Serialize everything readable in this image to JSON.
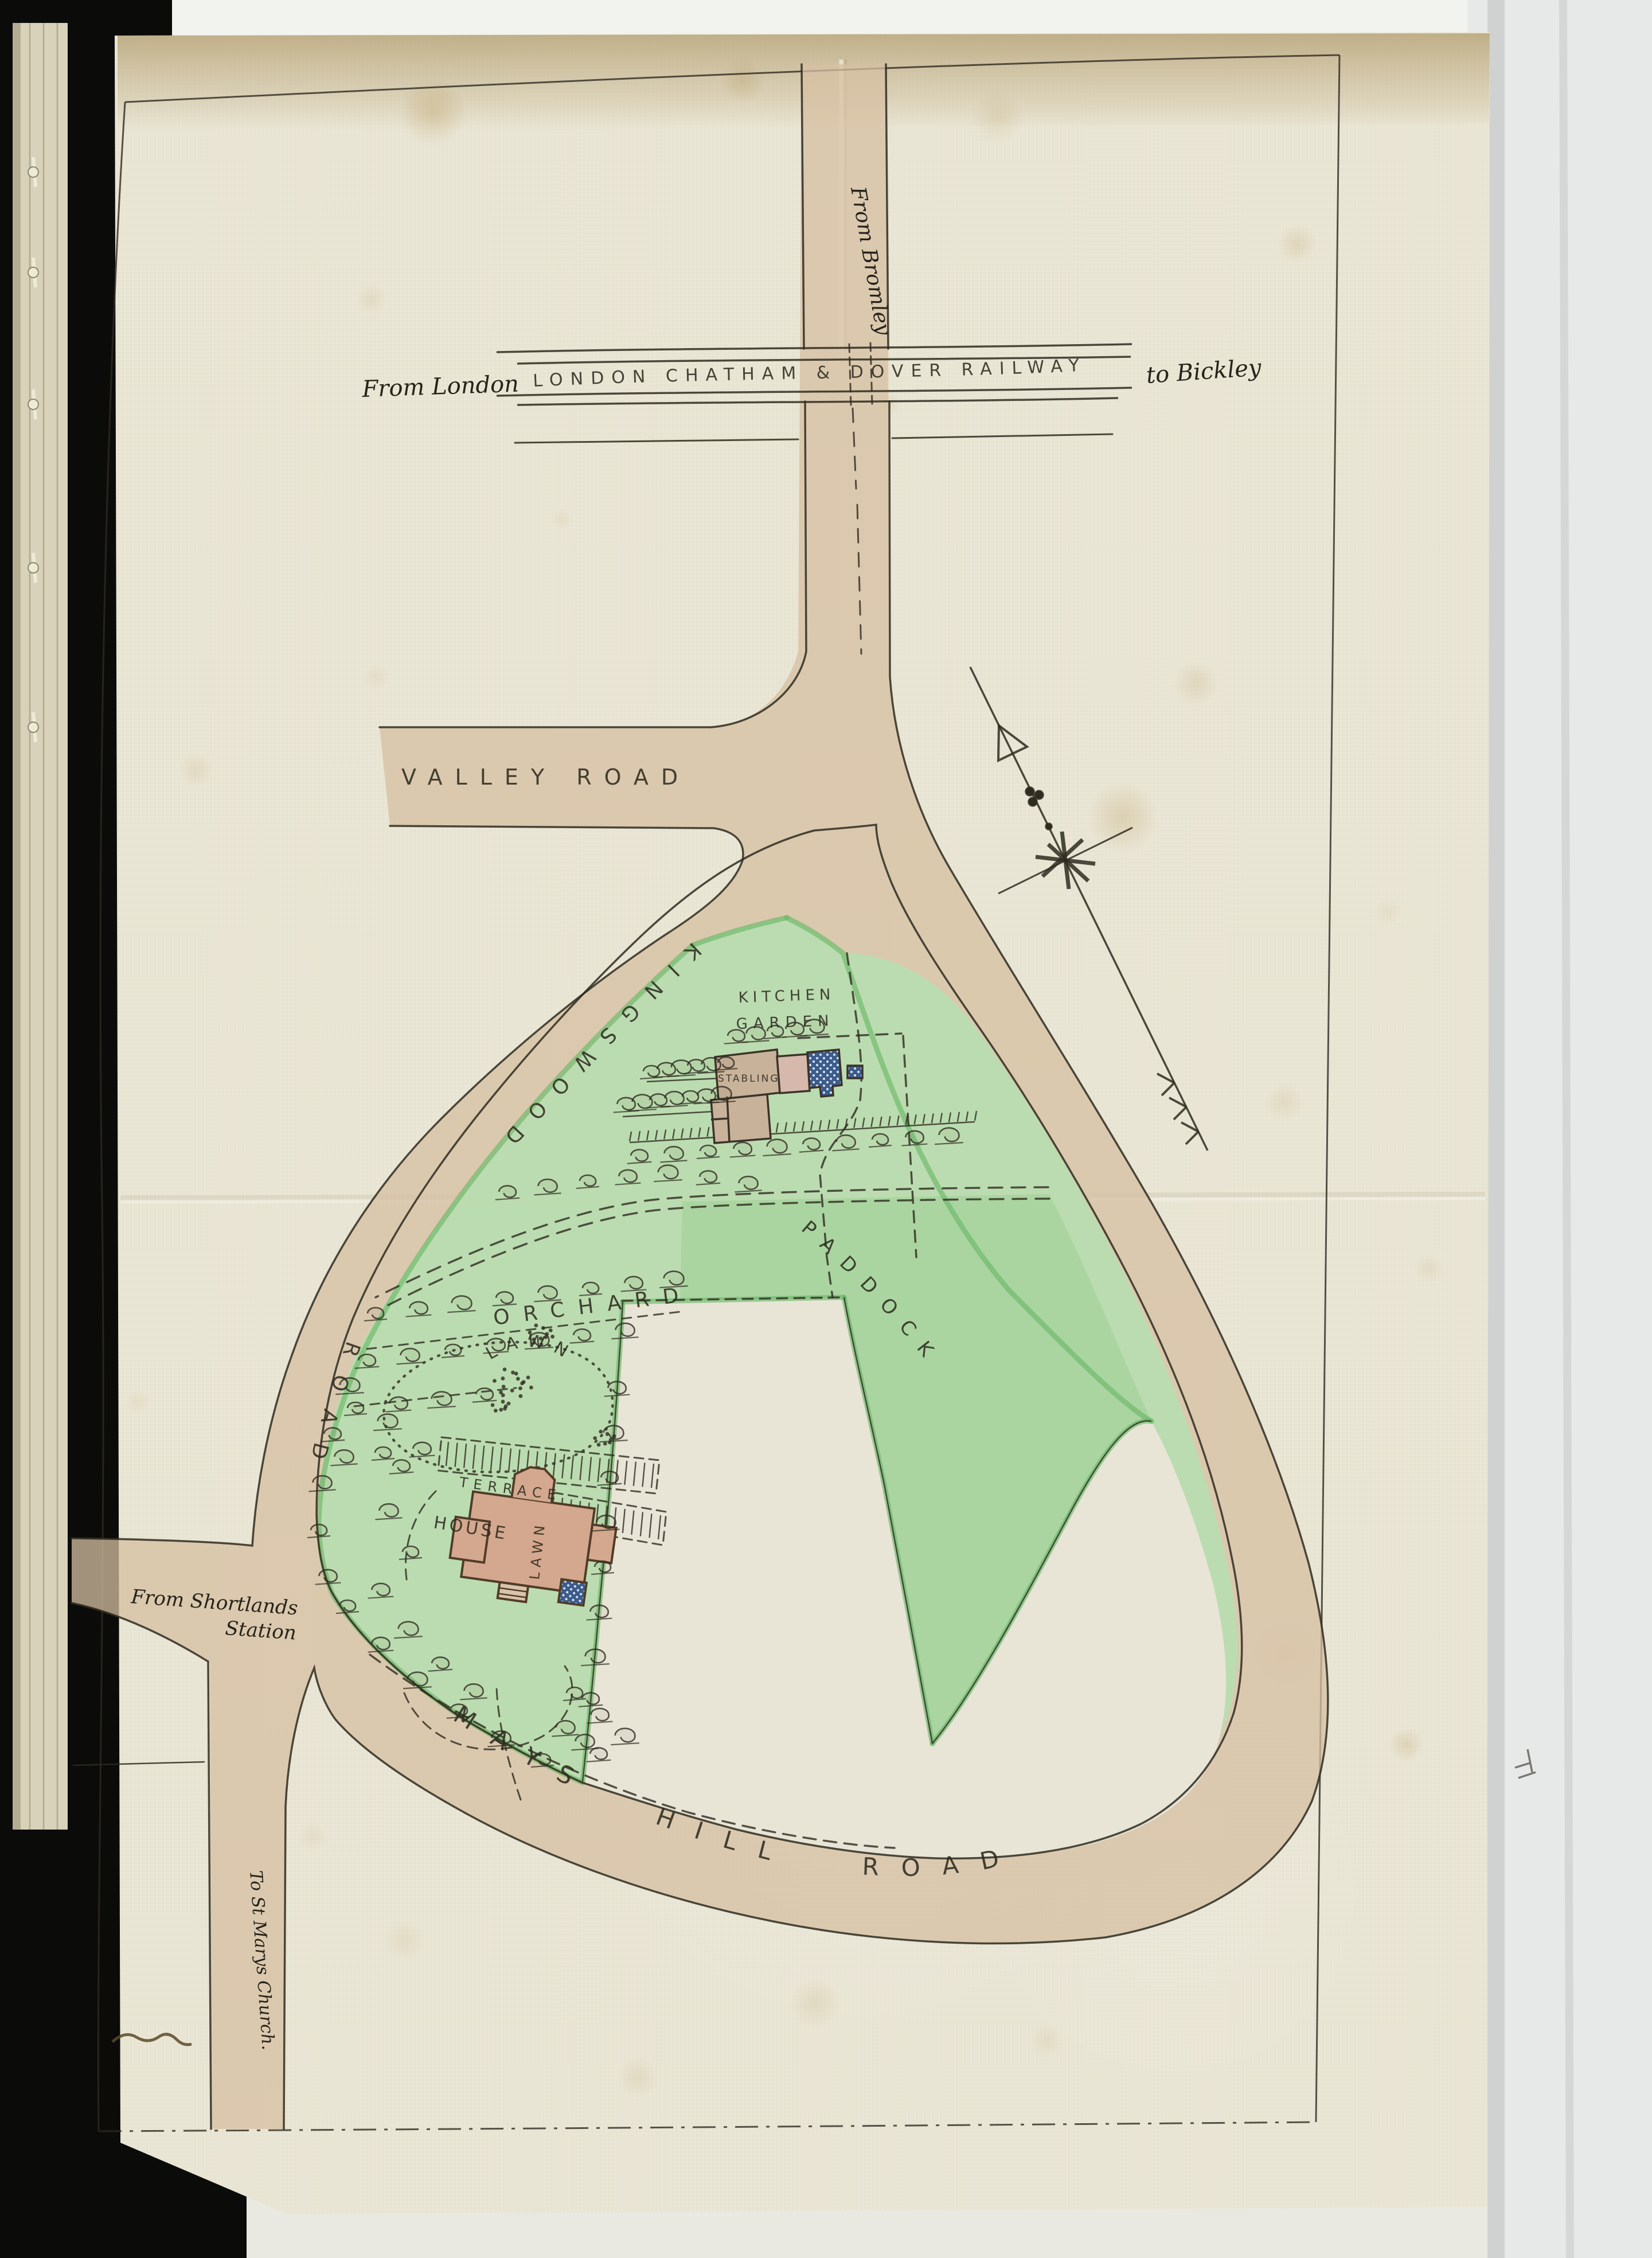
{
  "labels": {
    "from_bromley": "From Bromley",
    "from_london": "From London",
    "railway": "LONDON CHATHAM & DOVER RAILWAY",
    "to_bickley": "to Bickley",
    "valley_road": "VALLEY ROAD",
    "kingswood": "KINGSWOOD",
    "kingswood_road": "ROAD",
    "kitchen_garden_1": "KITCHEN",
    "kitchen_garden_2": "GARDEN",
    "stabling": "STABLING",
    "orchard": "ORCHARD",
    "paddock": "PADDOCK",
    "lawn": "LAWN",
    "terrace": "TERRACE",
    "house": "HOUSE",
    "lawn_small": "LAWN",
    "from_shortlands_1": "From Shortlands",
    "from_shortlands_2": "Station",
    "mays_hill_road": "MAYS HILL ROAD",
    "to_st_marys": "To St Marys Church."
  },
  "colors": {
    "ink": "#2e2b20",
    "road_tan": "#d5bfa2",
    "estate_green": "#b9ddb0",
    "green_edge": "#6cb868",
    "house_pink": "#d4a88e",
    "roof_blue": "#3c5c8e",
    "sheet": "#e9e5d4"
  }
}
